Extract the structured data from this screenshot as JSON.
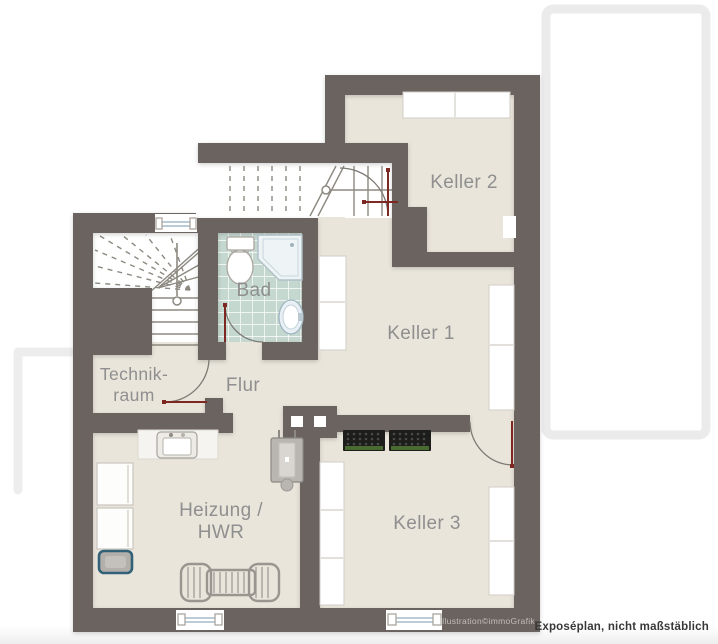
{
  "plan": {
    "type": "basement floor plan",
    "rooms": {
      "keller2": {
        "label": "Keller 2"
      },
      "keller1": {
        "label": "Keller 1"
      },
      "keller3": {
        "label": "Keller 3"
      },
      "bad": {
        "label": "Bad"
      },
      "flur": {
        "label": "Flur"
      },
      "technikraum": {
        "line1": "Technik-",
        "line2": "raum"
      },
      "heizung": {
        "line1": "Heizung /",
        "line2": "HWR"
      }
    },
    "annotations": {
      "watermark": "illustration©immoGrafik",
      "disclaimer": "Exposéplan, nicht maßstäblich"
    },
    "fixtures": [
      "main-staircase",
      "winder-staircase",
      "toilet",
      "shower",
      "washbasin",
      "sink-unit",
      "washing-machine",
      "washing-machine",
      "laundry-basket",
      "wall-boiler",
      "chimney",
      "radiator",
      "beverage-crates",
      "shelf-units",
      "cellar-windows",
      "door-swings"
    ]
  },
  "colors": {
    "wall": "#6b6360",
    "floor": "#e9e5db",
    "tile": "#c5d8d0",
    "door-red": "#7e2824",
    "stairline": "#8d8981",
    "label": "#8f8f8f",
    "watermark": "#c3beb8",
    "disclaimer": "#383838",
    "outline": "#ebebeb",
    "shelf-stroke": "#d2cec6",
    "window-blue": "#a5bcc8",
    "crate-green": "#4a6b2f",
    "basket-teal": "#336178"
  }
}
